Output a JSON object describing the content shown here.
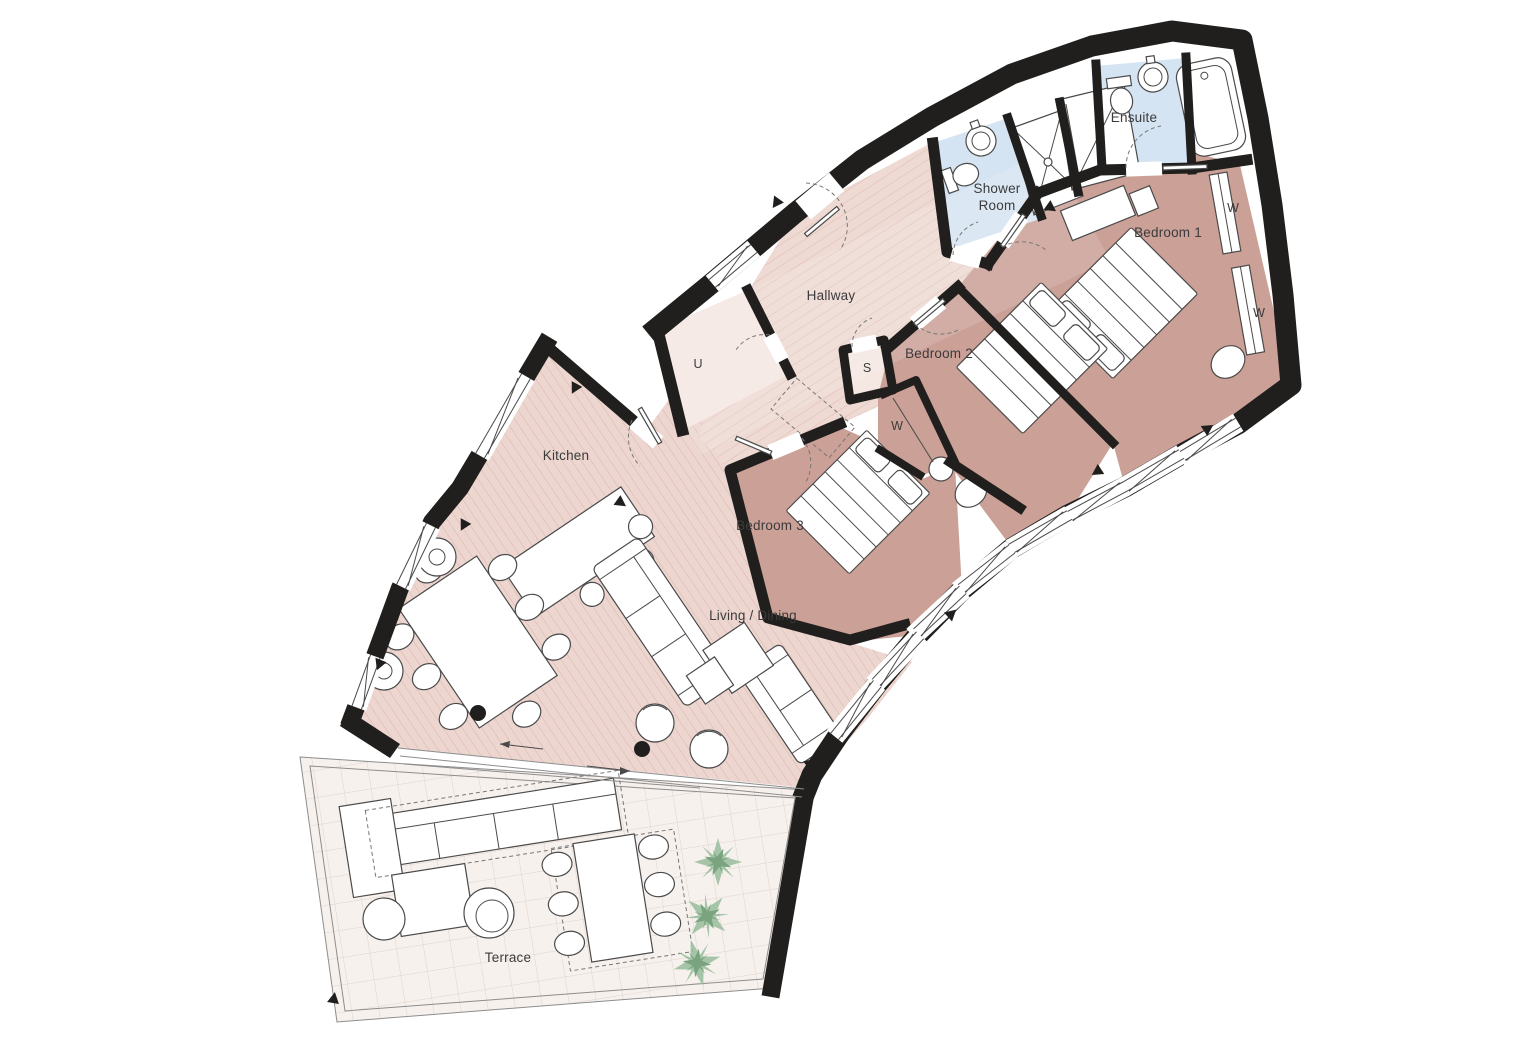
{
  "plan": {
    "labels": {
      "shower_room_1": "Shower",
      "shower_room_2": "Room",
      "ensuite": "Ensuite",
      "bedroom1": "Bedroom 1",
      "bedroom2": "Bedroom 2",
      "bedroom3": "Bedroom 3",
      "hallway": "Hallway",
      "kitchen": "Kitchen",
      "living_dining": "Living / Dining",
      "terrace": "Terrace",
      "utility": "U",
      "store": "S",
      "wardrobe": "W"
    },
    "colors": {
      "wall": "#201f1d",
      "bedroom": "#cba097",
      "wood": "#ecd6cf",
      "hallway": "#eedad3",
      "closet": "#f5e7e2",
      "bathroom": "#d5e4f2",
      "terrace": "#f7f1ee",
      "plant": "#8ab38f",
      "label": "#3b3b3b"
    }
  }
}
